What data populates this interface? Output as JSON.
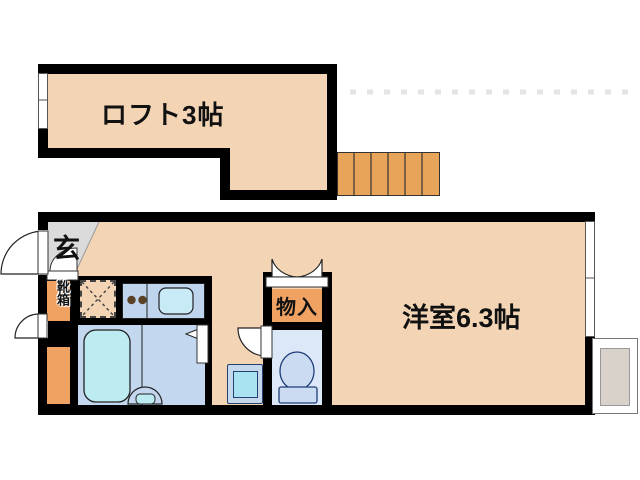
{
  "plan": {
    "type": "apartment-floor-plan",
    "rooms": {
      "loft": {
        "label": "ロフト3帖"
      },
      "western_room": {
        "label": "洋室6.3帖"
      },
      "entrance": {
        "label": "玄"
      },
      "closet": {
        "label": "物入"
      },
      "shoe_box": {
        "label": "靴箱"
      }
    },
    "stairs": {
      "steps": 6
    },
    "fixtures": [
      "entrance-door",
      "bathtub",
      "wash-basin",
      "kitchen-stove",
      "kitchen-sink",
      "refrigerator-space",
      "toilet",
      "washing-machine-pan",
      "outdoor-unit"
    ],
    "colors": {
      "wall": "#000000",
      "floor": "#F3D5B5",
      "stairs": "#E8A55A",
      "storage_orange": "#F0A263",
      "entrance_gray": "#DBDBDB",
      "bath_floor": "#C3D8EE",
      "bathtub": "#BDEBF2",
      "kitchen_counter": "#BFD5EE",
      "sink": "#C8E9F6",
      "toilet_floor": "#DCE8F8",
      "fixture_blue": "#CBDCF2",
      "washer": "#A9E3F2",
      "outdoor_unit": "#D9D2CA"
    }
  }
}
